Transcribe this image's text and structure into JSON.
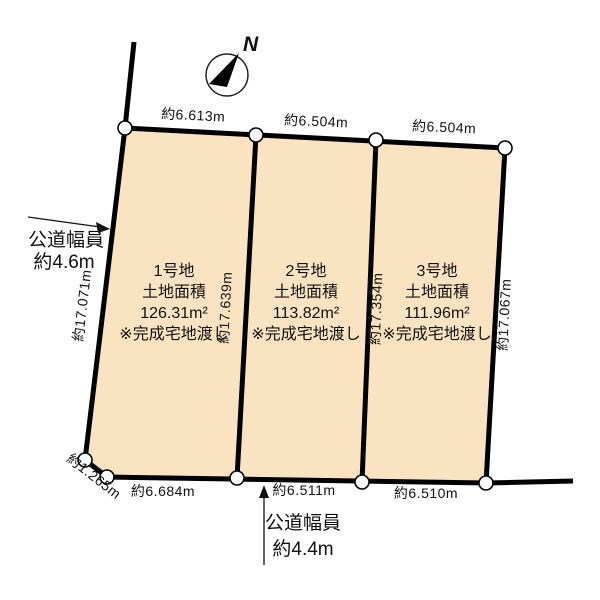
{
  "diagram_title": "分譲地区画図",
  "colors": {
    "parcel_fill": "#FAE3C0",
    "line": "#000000",
    "background": "#FFFFFF"
  },
  "compass": {
    "label": "N"
  },
  "roads": {
    "left": {
      "line1": "公道幅員",
      "line2": "約4.6m"
    },
    "bottom": {
      "line1": "公道幅員",
      "line2": "約4.4m"
    }
  },
  "dimensions": {
    "top": [
      "約6.613m",
      "約6.504m",
      "約6.504m"
    ],
    "bottom": [
      "約6.684m",
      "約6.511m",
      "約6.510m"
    ],
    "left": "約17.071m",
    "divider1": "約17.639m",
    "divider2": "約17.354m",
    "right": "約17.067m",
    "chamfer": "約1.265m"
  },
  "parcels": [
    {
      "name": "1号地",
      "area_label": "土地面積",
      "area": "126.31m²",
      "note": "※完成宅地渡し"
    },
    {
      "name": "2号地",
      "area_label": "土地面積",
      "area": "113.82m²",
      "note": "※完成宅地渡し"
    },
    {
      "name": "3号地",
      "area_label": "土地面積",
      "area": "111.96m²",
      "note": "※完成宅地渡し"
    }
  ]
}
